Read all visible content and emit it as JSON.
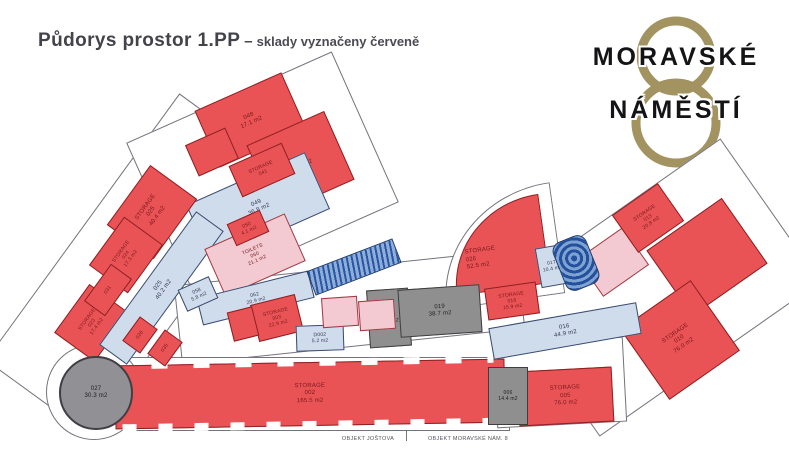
{
  "header": {
    "title": "Půdorys prostor 1.PP",
    "separator": "–",
    "subtitle": "sklady vyznačeny červeně"
  },
  "logo": {
    "line1": "MORAVSKÉ",
    "line2": "NÁMĚSTÍ",
    "gold_color": "#a39360",
    "text_color": "#141416"
  },
  "colors": {
    "storage_red": "#ea5355",
    "corridor_blue": "#cfdcec",
    "toilets_pink": "#f3cad2",
    "utility_gray": "#8f8f8f",
    "stairs_blue": "#2a57a4",
    "wall_outline": "#73737d"
  },
  "rooms": [
    {
      "key": "s048",
      "kind": "red",
      "title": "",
      "code": "048",
      "area": "17.1 m2"
    },
    {
      "key": "r045",
      "kind": "red",
      "title": "",
      "code": "",
      "area": ""
    },
    {
      "key": "st041",
      "kind": "red",
      "title": "STORAGE",
      "code": "041",
      "area": ""
    },
    {
      "key": "s046",
      "kind": "red",
      "title": "",
      "code": "046",
      "area": "19.5 m2"
    },
    {
      "key": "hall049",
      "kind": "blue",
      "title": "",
      "code": "049",
      "area": "36.8 m2"
    },
    {
      "key": "s050",
      "kind": "red",
      "title": "",
      "code": "050",
      "area": "4.1 m2"
    },
    {
      "key": "t060",
      "kind": "pink",
      "title": "TOILETS",
      "code": "060",
      "area": "21.1 m2"
    },
    {
      "key": "r058",
      "kind": "blue",
      "title": "",
      "code": "058",
      "area": "5.8 m2"
    },
    {
      "key": "st025",
      "kind": "red",
      "title": "STORAGE",
      "code": "025",
      "area": "40.4 m2"
    },
    {
      "key": "st024",
      "kind": "red",
      "title": "STORAGE",
      "code": "024",
      "area": "17.3 m2"
    },
    {
      "key": "r031",
      "kind": "red",
      "title": "",
      "code": "031",
      "area": ""
    },
    {
      "key": "st023",
      "kind": "red",
      "title": "STORAGE",
      "code": "023",
      "area": "17.4 m2"
    },
    {
      "key": "cor025",
      "kind": "blue",
      "title": "",
      "code": "025",
      "area": "40.2 m2"
    },
    {
      "key": "r026s",
      "kind": "red",
      "title": "",
      "code": "026",
      "area": ""
    },
    {
      "key": "r035s",
      "kind": "red",
      "title": "",
      "code": "035",
      "area": ""
    },
    {
      "key": "cor062",
      "kind": "blue",
      "title": "",
      "code": "062",
      "area": "20.9 m2"
    },
    {
      "key": "st003",
      "kind": "red",
      "title": "STORAGE",
      "code": "003",
      "area": "22.9 m2"
    },
    {
      "key": "r052",
      "kind": "red",
      "title": "",
      "code": "",
      "area": ""
    },
    {
      "key": "d002",
      "kind": "blue",
      "title": "",
      "code": "D002",
      "area": "5.2 m2"
    },
    {
      "key": "escalator",
      "kind": "stairs",
      "title": "",
      "code": "",
      "area": ""
    },
    {
      "key": "tp1",
      "kind": "pink",
      "title": "",
      "code": "",
      "area": ""
    },
    {
      "key": "tp2",
      "kind": "pink",
      "title": "",
      "code": "",
      "area": ""
    },
    {
      "key": "g015",
      "kind": "gray",
      "title": "",
      "code": "015",
      "area": "20.5 m2"
    },
    {
      "key": "g019",
      "kind": "gray",
      "title": "",
      "code": "019",
      "area": "38.7 m2"
    },
    {
      "key": "st026",
      "kind": "red",
      "title": "STORAGE",
      "code": "026",
      "area": "52.5 m2"
    },
    {
      "key": "b017",
      "kind": "blue",
      "title": "",
      "code": "017",
      "area": "10.4 m2"
    },
    {
      "key": "spiral",
      "kind": "spiral",
      "title": "",
      "code": "",
      "area": ""
    },
    {
      "key": "tpr",
      "kind": "pink",
      "title": "",
      "code": "",
      "area": ""
    },
    {
      "key": "st013",
      "kind": "red",
      "title": "STORAGE",
      "code": "013",
      "area": "20.8 m2"
    },
    {
      "key": "bigred",
      "kind": "red",
      "title": "",
      "code": "",
      "area": ""
    },
    {
      "key": "st010",
      "kind": "red",
      "title": "STORAGE",
      "code": "010",
      "area": "76.0 m2"
    },
    {
      "key": "st016",
      "kind": "red",
      "title": "STORAGE",
      "code": "016",
      "area": "15.9 m2"
    },
    {
      "key": "cor016",
      "kind": "blue",
      "title": "",
      "code": "016",
      "area": "44.9 m2"
    },
    {
      "key": "st005",
      "kind": "red",
      "title": "STORAGE",
      "code": "005",
      "area": "76.0 m2"
    },
    {
      "key": "g006",
      "kind": "gray",
      "title": "",
      "code": "006",
      "area": "14.4 m2"
    },
    {
      "key": "st002",
      "kind": "red",
      "title": "STORAGE",
      "code": "002",
      "area": "165.5 m2"
    },
    {
      "key": "tower027",
      "kind": "tower",
      "title": "",
      "code": "027",
      "area": "30.3 m2"
    }
  ],
  "footer": {
    "left": "OBJEKT JOŠTOVA",
    "right": "OBJEKT MORAVSKÉ NÁM. 8"
  }
}
